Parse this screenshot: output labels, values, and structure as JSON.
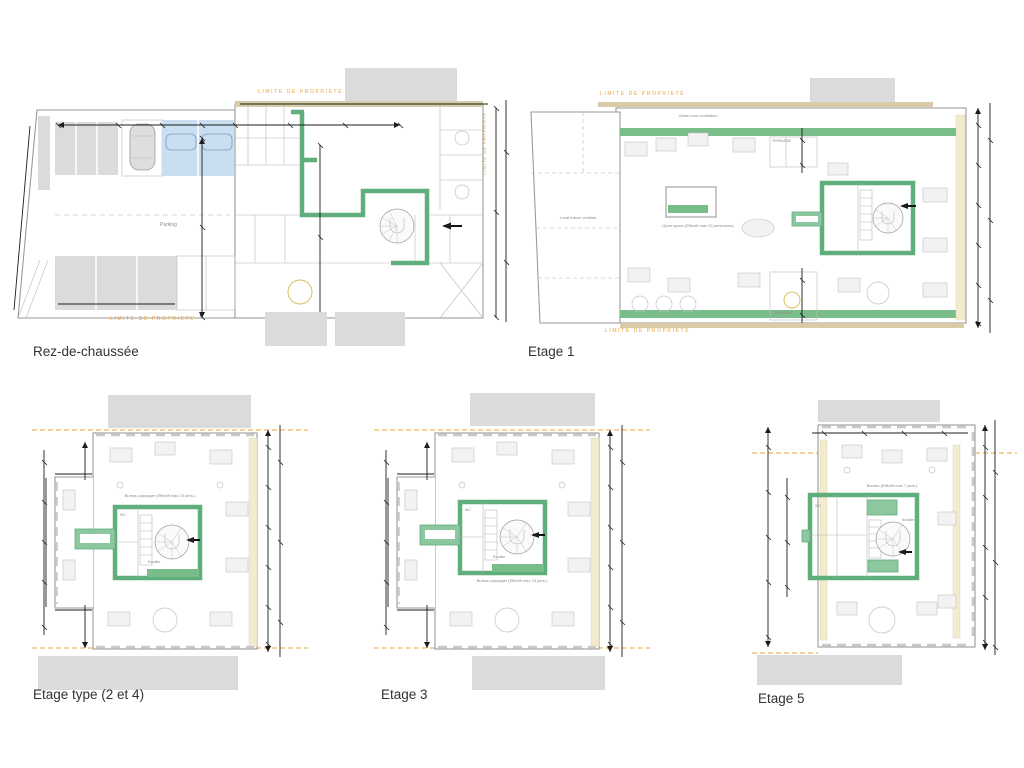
{
  "sheet_title": "Plans des étages",
  "boundary_label": "LIMITE DE PROPRIETE",
  "floors": [
    {
      "label": "Rez-de-chaussée"
    },
    {
      "label": "Etage 1"
    },
    {
      "label": "Etage type (2 et 4)"
    },
    {
      "label": "Etage 3"
    },
    {
      "label": "Etage 5"
    }
  ],
  "annotations": {
    "parking": "Parking",
    "ventilation": "Gaine pour ventilation",
    "local_toiture": "Local toiture ventilée",
    "open_space": "Open space (Effectif max 23 personnes)",
    "terrasse": "TERRASSE",
    "bureau_paysager": "Bureau paysager (Effectif max 23 pers.)",
    "bureau_etage5": "Bureau (Effectif max 7 pers.)",
    "escalier": "Escalier",
    "wc": "WC"
  },
  "colors": {
    "green_wall": "#5FAE7C",
    "green_fill": "#8CC7A0",
    "green_band": "#79BD8B",
    "property_orange": "#E8A13C",
    "tan_wall": "#D9CBA8",
    "window_band": "#F2ECCE",
    "adjacent_gray": "#DBDBDB",
    "parking_blue": "#C9DEF0",
    "wall_line": "#9A9A9A",
    "dimension_black": "#1C1C1C"
  }
}
